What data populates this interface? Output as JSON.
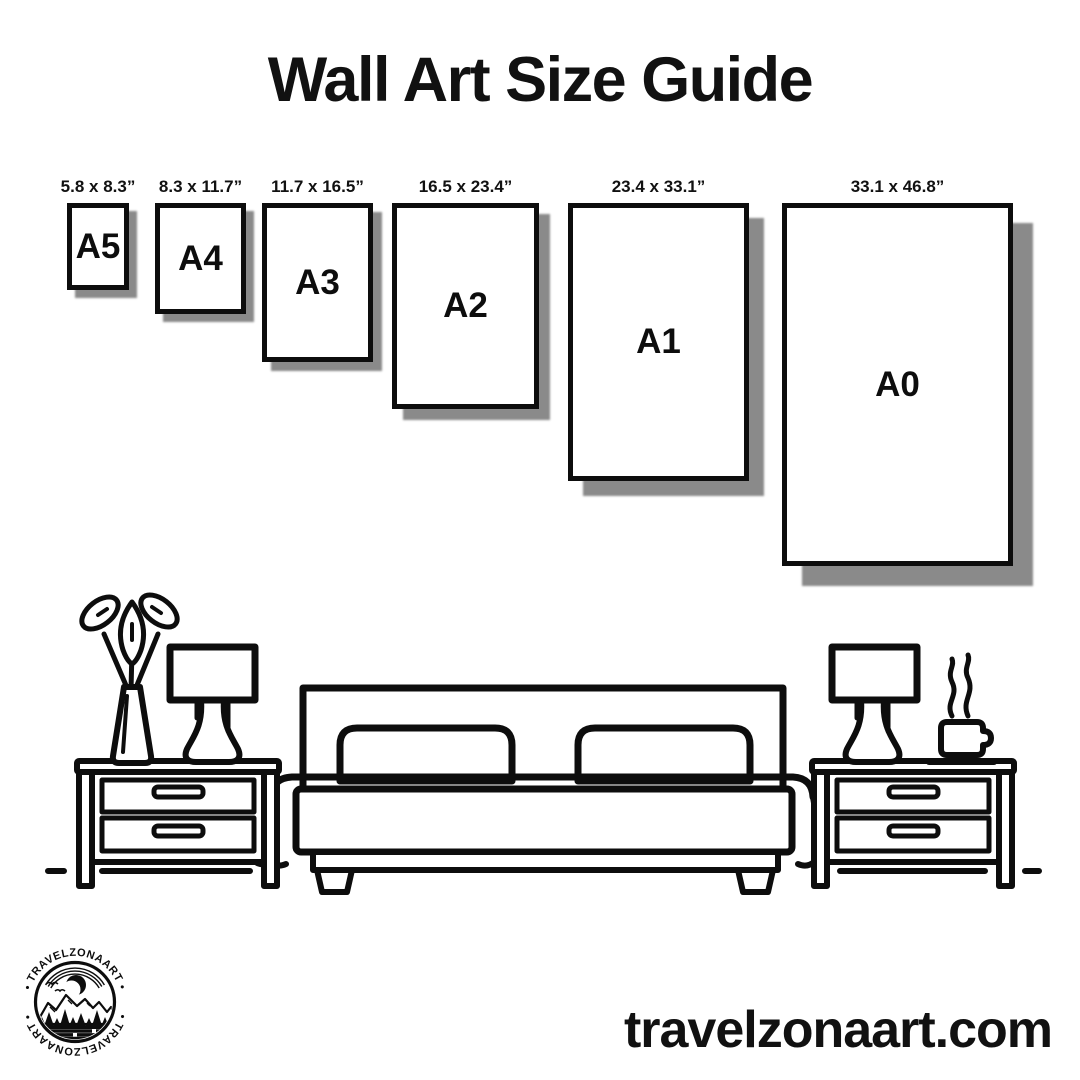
{
  "title": "Wall Art Size Guide",
  "sizes": {
    "top": 203,
    "items": [
      {
        "code": "A5",
        "dims": "5.8 x 8.3”",
        "x": 67,
        "w": 62,
        "h": 87
      },
      {
        "code": "A4",
        "dims": "8.3 x 11.7”",
        "x": 155,
        "w": 91,
        "h": 111
      },
      {
        "code": "A3",
        "dims": "11.7 x 16.5”",
        "x": 262,
        "w": 111,
        "h": 159
      },
      {
        "code": "A2",
        "dims": "16.5 x 23.4”",
        "x": 392,
        "w": 147,
        "h": 206
      },
      {
        "code": "A1",
        "dims": "23.4 x 33.1”",
        "x": 568,
        "w": 181,
        "h": 278
      },
      {
        "code": "A0",
        "dims": "33.1 x 46.8”",
        "x": 782,
        "w": 231,
        "h": 363
      }
    ]
  },
  "scene": {
    "name": "bedroom line art: bed with two pillows, nightstands with lamps, vase with plant, steaming coffee cup"
  },
  "logo": {
    "text_top": "• TRAVELZONAART •",
    "text_bottom": "• TRAVELZONAART •"
  },
  "footer": {
    "website": "travelzonaart.com"
  },
  "colors": {
    "ink": "#0d0d0d",
    "shadow": "#8a8a8a",
    "background": "#ffffff"
  }
}
